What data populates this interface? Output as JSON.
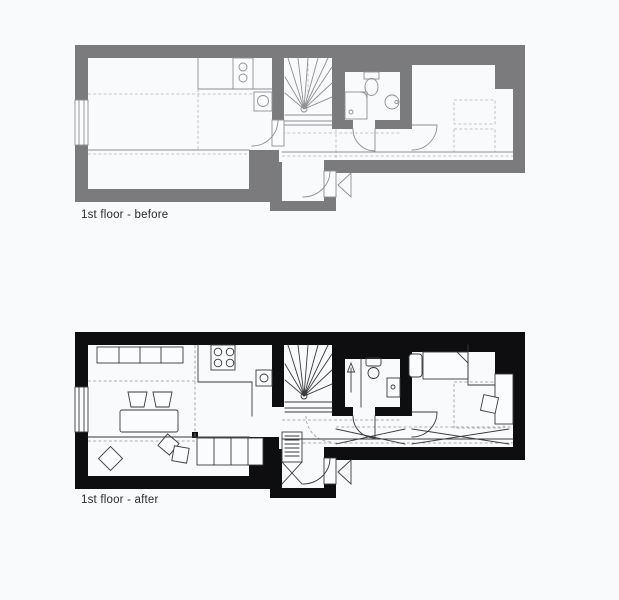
{
  "canvas": {
    "background": "#f8fafb"
  },
  "plans": {
    "before": {
      "label": "1st floor - before",
      "wall_color": "#7b7b7e",
      "line_color": "#8f8f94",
      "detail_color": "#b4b4ba",
      "fixtures": [
        "window",
        "kitchen-counter",
        "stove-2-burners",
        "kitchen-sink",
        "winder-staircase",
        "shower-tray",
        "toilet",
        "round-washbasin",
        "interior-door-arcs",
        "entrance-door",
        "entrance-direction-triangle",
        "dashed-bed-outlines"
      ]
    },
    "after": {
      "label": "1st floor - after",
      "wall_color": "#0e0e10",
      "line_color": "#3a3a3e",
      "detail_color": "#97979d",
      "fixtures": [
        "window",
        "wall-cabinet-row",
        "dining-table-with-two-chairs",
        "floor-cushions",
        "kitchen-counter",
        "stove-4-burners",
        "kitchen-sink",
        "winder-staircase",
        "shower-cabin-up-arrow",
        "toilet",
        "washbasin",
        "sideboard-units",
        "hallway-wardrobe-hangers",
        "sliding-wardrobe-crosses",
        "bed-with-pillow",
        "desk-with-chair",
        "entrance-door",
        "entrance-direction-triangle"
      ]
    }
  }
}
